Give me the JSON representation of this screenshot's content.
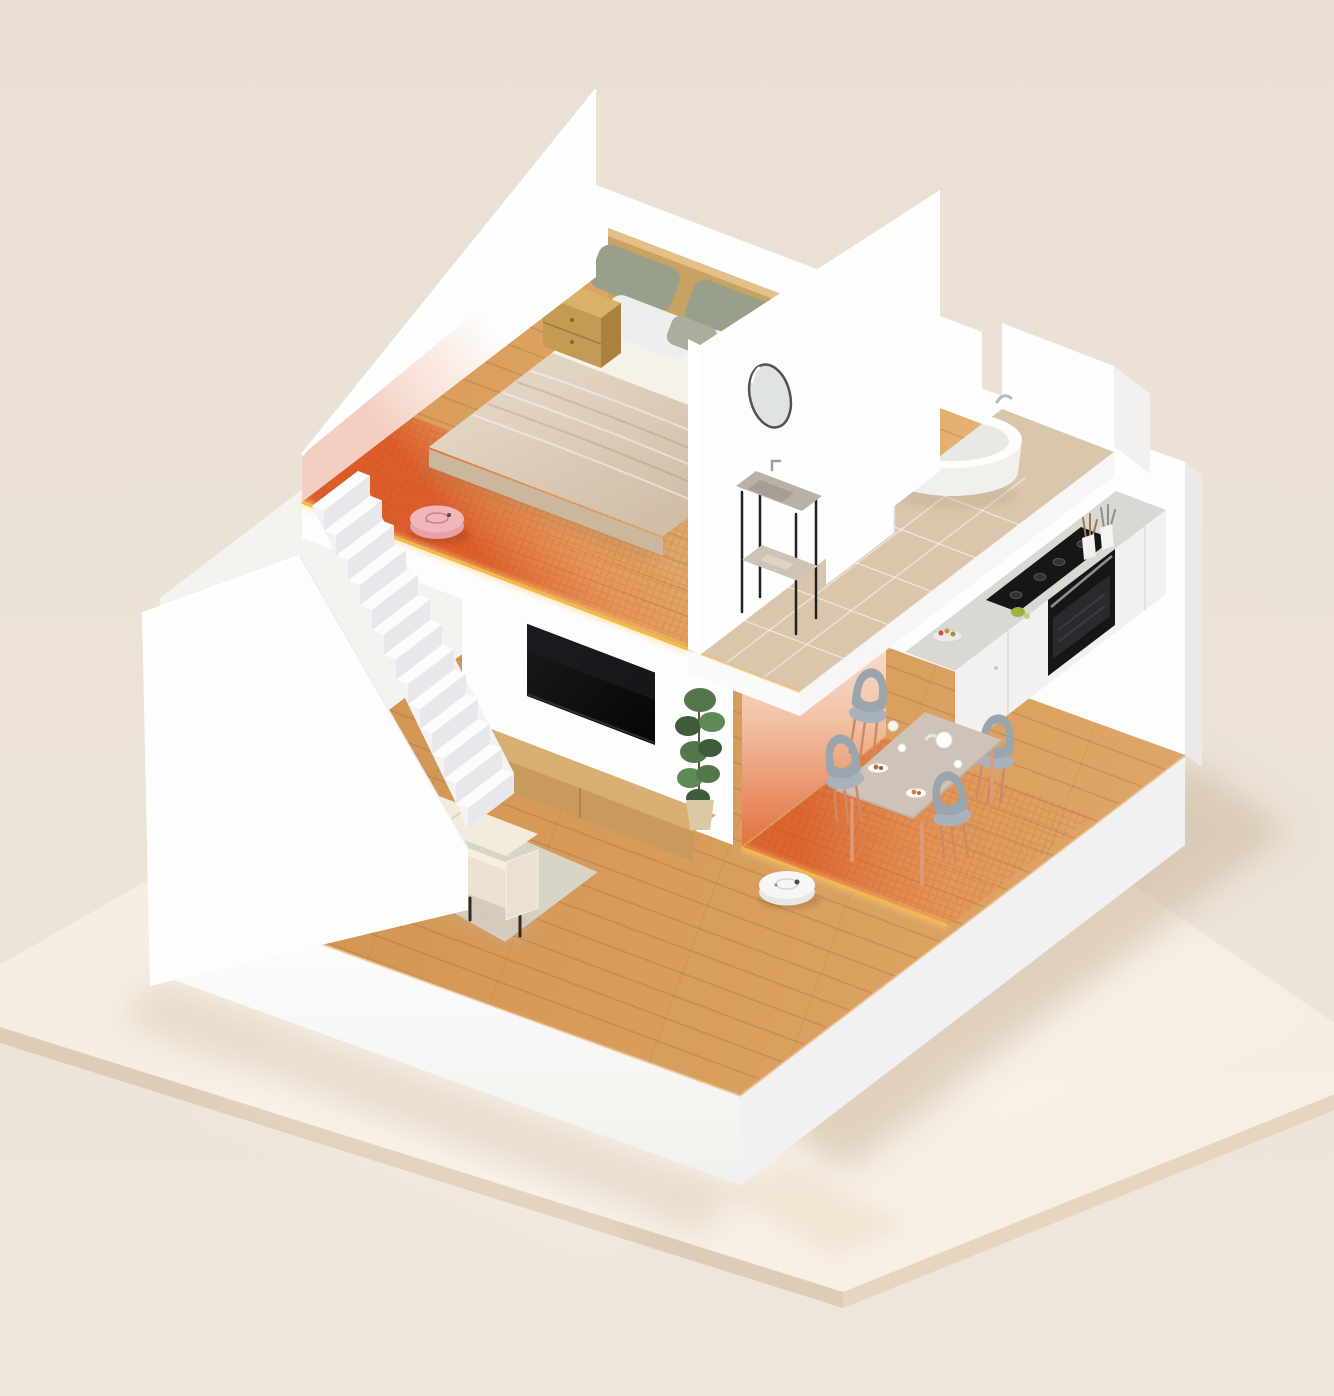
{
  "scene": {
    "title": "Isometric 3D cutaway render of a two-story smart home with robot vacuums cleaning heat-mapped zones",
    "style": "photorealistic isometric dollhouse render on a glossy cream platform",
    "floors": [
      {
        "name": "upper floor",
        "rooms": [
          {
            "name": "bedroom",
            "floor": "light wood with orange clean-zone gradient and grid texture along the open edge",
            "furniture": [
              "double bed with wooden headboard",
              "sage and white pillows",
              "beige quilted blanket",
              "wooden nightstand"
            ],
            "device": "pink robot vacuum on the clean zone"
          },
          {
            "name": "bathroom",
            "floor": "beige stone tile",
            "furniture": [
              "freestanding white oval bathtub",
              "round wall mirror",
              "two-tier sink stand with black legs"
            ]
          }
        ],
        "edge_effect": "glowing golden strip along the open slab edge"
      },
      {
        "name": "lower floor",
        "rooms": [
          {
            "name": "living room",
            "floor": "wood planks",
            "furniture": [
              "cream three-seat sofa with black legs",
              "gray-green area rug",
              "wall-mounted black TV",
              "low wooden TV console",
              "tall potted plant"
            ],
            "device": "white robot vacuum"
          },
          {
            "name": "dining area",
            "floor": "wood with orange clean-zone gradient under the table",
            "furniture": [
              "rectangular dining table",
              "four gray chairs with warm wood legs",
              "plates, cups and white teapot"
            ]
          },
          {
            "name": "kitchen",
            "furniture": [
              "white cabinet run with gray countertop",
              "black gas cooktop",
              "built-in black oven",
              "fruit bowl",
              "utensil cups"
            ]
          },
          {
            "name": "staircase",
            "furniture": [
              "white straight stair with thirteen steps",
              "white parapet wall"
            ]
          }
        ]
      }
    ],
    "devices": [
      {
        "name": "robot-vacuum-upper",
        "color_name": "pink",
        "location": "bedroom clean zone"
      },
      {
        "name": "robot-vacuum-lower",
        "color_name": "white",
        "location": "living room floor"
      }
    ],
    "effects": [
      "orange heat-map clean zones with fine grid texture",
      "glowing gold floor edges",
      "soft reflections and shadows on glossy platform"
    ]
  },
  "palette": {
    "bg": "#eadfd3",
    "platform_top": "#f4ecdf",
    "platform_front": "#f7f0e5",
    "platform_edge_l": "#decdb6",
    "platform_edge_r": "#e6d6c0",
    "wall_white": "#fdfdfe",
    "wall_warm": "#f5f3f0",
    "wall_shade": "#ececf0",
    "wood_light": "#dfa768",
    "wood_dark": "#d0924f",
    "wood_up_light": "#e6b274",
    "wood_up_dark": "#d79a58",
    "heat_core": "#dc5c28",
    "heat_mid": "#ea8a52",
    "gold": "#f2b94b",
    "gold_glow": "#ffd27a",
    "tile": "#d9c6ac",
    "tile_line": "#ffffff",
    "tv_black": "#0c0c0e",
    "console_top": "#d9ae72",
    "console_front": "#c89a5e",
    "plant_dark": "#3e5c38",
    "plant_mid": "#53774a",
    "plant_light": "#5f8a55",
    "pot": "#dcc8a4",
    "counter_top": "#dad8d3",
    "counter_front": "#f2f1f0",
    "appliance": "#161617",
    "chair_body": "#9aa5ad",
    "chair_leg": "#d08a62",
    "table_top": "#cfc3b7",
    "rug": "#d8d4c6",
    "sofa_body": "#ece1d0",
    "sofa_light": "#f3ebdb",
    "blanket_1": "#e2d4c2",
    "blanket_2": "#cfbda6",
    "sheet": "#f6f2ea",
    "pillow_sage": "#99a08a",
    "pillow_white": "#edefec",
    "headboard": "#c8a261",
    "nightstand_top": "#d9b26a",
    "nightstand_front": "#c49a55",
    "nightstand_side": "#ab813f",
    "stand_top": "#b9b1a5",
    "stand_shelf": "#cdc4b6",
    "tub": "#fdfdfc",
    "tub_inner": "#e9e8e4",
    "robot_pink": "#f0b6ba",
    "robot_pink_side": "#e5a2a8",
    "robot_white": "#f7f6f4",
    "robot_white_side": "#e9e7e4",
    "shadow_warm": "#c9b49a",
    "glow_wall_base": "#e2703f"
  }
}
